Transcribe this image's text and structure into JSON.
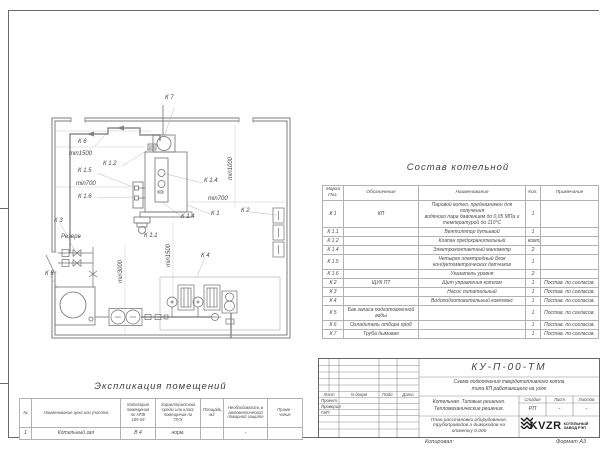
{
  "sheet": {
    "kopiroval": "Копировал:",
    "format": "Формат А3"
  },
  "bom": {
    "title": "Состав котельной",
    "headers": [
      "Марка\nПоз.",
      "Обозначение",
      "Наименование",
      "Кол.",
      "Примечание"
    ],
    "rows": [
      [
        "К 1",
        "КП",
        "Паровой котел, предназначен для получения\nводяного пара давлением до 0,05 МПа и\nтемпературой до 110°С",
        "1",
        ""
      ],
      [
        "К 1.1",
        "",
        "Вентилятор дутьевой",
        "1",
        ""
      ],
      [
        "К 1.2",
        "",
        "Клапан предохранительный",
        "компл.",
        ""
      ],
      [
        "К 1.4",
        "",
        "Электроконтактный манометр",
        "2",
        ""
      ],
      [
        "К 1.5",
        "",
        "Четырех электродный блок\nкондуктометрических датчиков",
        "1",
        ""
      ],
      [
        "К 1.6",
        "",
        "Указатель уровня",
        "2",
        ""
      ],
      [
        "К 2",
        "ЩУК ПТ",
        "Щит управления котлом",
        "1",
        "Постав. по согласов."
      ],
      [
        "К 3",
        "",
        "Насос питательный",
        "1",
        "Постав. по согласов."
      ],
      [
        "К 4",
        "",
        "Водоподготовительный комплекс",
        "1",
        "Постав. по согласов."
      ],
      [
        "К 5",
        "Бак запаса подготовленной\nводы",
        "",
        "1",
        "Постав. по согласов."
      ],
      [
        "К 6",
        "Охладитель отбора проб",
        "",
        "1",
        "Постав. по согласов."
      ],
      [
        "К 7",
        "Труба дымовая",
        "",
        "1",
        "Постав. по согласов."
      ]
    ]
  },
  "explication": {
    "title": "Экспликация помещений",
    "headers": [
      "№",
      "Наименование цеха или участка",
      "Категория\nпомещения\nпо НПБ\n105-03",
      "Характеристика\nсреды или класс\nпомещения по\nПУЭ",
      "Площадь,\nм2",
      "Необходимость в\nавтоматической\nпожарной защите",
      "Приме -\nчание"
    ],
    "rows": [
      [
        "1",
        "Котельный зал",
        "В 4",
        "норм.",
        "",
        "-",
        ""
      ]
    ]
  },
  "titleblock": {
    "doc_number": "КУ-П-00-ТМ",
    "scheme_title": "Схема подключения твердотопливного котла\nтипа КП работающего на угле",
    "object_title": "Котельная. Типовые решения.\nТепломеханические решения.",
    "sheet_title": "План расстановки оборудования,\nтрубопроводов и дымоходов на\nотметку 0,000",
    "cols": [
      "Лист",
      "N докум",
      "Подп.",
      "Дата"
    ],
    "roles": [
      "Проект.",
      "Проверил",
      "ГИП"
    ],
    "stage_cols": [
      "Стадия",
      "Лист",
      "Листов"
    ],
    "stage": "РП",
    "sheet_no": "-",
    "sheets_total": "-",
    "logo_text": "KVZR",
    "logo_caption": "КОТЕЛЬНЫЙ\nЗАВОД РЭП"
  },
  "plan": {
    "labels": [
      {
        "text": "К 7",
        "x": 120,
        "y": 0
      },
      {
        "text": "К 6",
        "x": 33,
        "y": 44
      },
      {
        "text": "min1500",
        "x": 24,
        "y": 56
      },
      {
        "text": "К 1.2",
        "x": 58,
        "y": 66
      },
      {
        "text": "К 1.5",
        "x": 33,
        "y": 73
      },
      {
        "text": "min700",
        "x": 31,
        "y": 86
      },
      {
        "text": "К 1.6",
        "x": 33,
        "y": 99
      },
      {
        "text": "К 1.4",
        "x": 159,
        "y": 83
      },
      {
        "text": "min700",
        "x": 163,
        "y": 101
      },
      {
        "text": "К 1",
        "x": 166,
        "y": 116
      },
      {
        "text": "К 2",
        "x": 196,
        "y": 113
      },
      {
        "text": "К 1.4",
        "x": 136,
        "y": 119
      },
      {
        "text": "К 1.1",
        "x": 99,
        "y": 138
      },
      {
        "text": "К 3",
        "x": 9,
        "y": 123
      },
      {
        "text": "Резерв",
        "x": 16,
        "y": 139
      },
      {
        "text": "К 5",
        "x": 0,
        "y": 176
      },
      {
        "text": "К 4",
        "x": 156,
        "y": 158
      },
      {
        "text": "min1000",
        "x": 183,
        "y": 85,
        "vert": true
      },
      {
        "text": "min3000",
        "x": 73,
        "y": 188,
        "vert": true
      },
      {
        "text": "min1500",
        "x": 121,
        "y": 172,
        "vert": true
      }
    ]
  }
}
